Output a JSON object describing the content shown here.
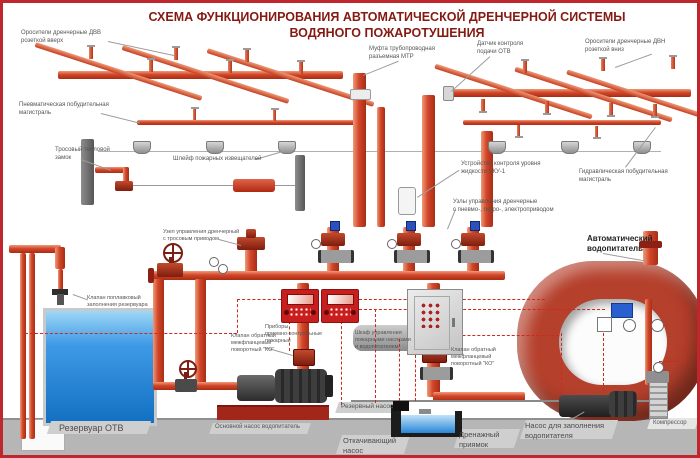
{
  "title": {
    "line1": "СХЕМА ФУНКЦИОНИРОВАНИЯ АВТОМАТИЧЕСКОЙ ДРЕНЧЕРНОЙ СИСТЕМЫ",
    "line2": "ВОДЯНОГО ПОЖАРОТУШЕНИЯ"
  },
  "labels": {
    "sprinklers_up": "Оросители дренчерные ДВВ\nрозеткой вверх",
    "pneumatic_main": "Пневматическая побудительная\nмагистраль",
    "cable_lock": "Тросовый тепловой\nзамок",
    "detector_loop": "Шлейф пожарных извещателей",
    "coupling_mtr": "Муфта трубопроводная\nразъемная МТР",
    "otv_sensor": "Датчик контроля\nподачи ОТВ",
    "sprinklers_down": "Оросители дренчерные ДВН\nрозеткой вниз",
    "level_control": "Устройство контроля уровня\nжидкости УКУ-1",
    "hydraulic_main": "Гидравлическая побудительная\nмагистраль",
    "control_units": "Узлы управления дренчерные\nс пневмо-, гидро-, электроприводом",
    "cable_unit": "Узел управления дренчерный\nс тросовым приводом",
    "float_valve": "Клапан поплавковый\nзаполнения резервуара",
    "auto_feeder": "Автоматический\nводопитатель",
    "check_valve_1": "Клапан обратный\nмежфланцевый\nповоротный \"КО\"",
    "check_valve_2": "Клапан обратный\nмежфланцевый\nповоротный \"КО\"",
    "control_panels": "Приборы\nприемно-контрольные\nпожарные",
    "control_cabinet": "Шкаф управления\nпожарными насосами\nи водопитателем",
    "reservoir": "Резервуар ОТВ",
    "main_pump": "Основной насос водопитатель",
    "reserve_pump": "Резервный насос",
    "drain_pump": "Откачивающий\nнасос",
    "drain_pit": "Дренажный\nприямок",
    "fill_pump": "Насос для заполнения\nводопитателя",
    "compressor": "Компрессор"
  },
  "colors": {
    "frame": "#c0272d",
    "pipe": "#d2462a",
    "title_text": "#841a12",
    "water": "#2e8fe0",
    "panel_red": "#c81e1e",
    "feeder_torus": "#b5402c",
    "floor": "#b6b6b6",
    "label_text": "#555555"
  }
}
